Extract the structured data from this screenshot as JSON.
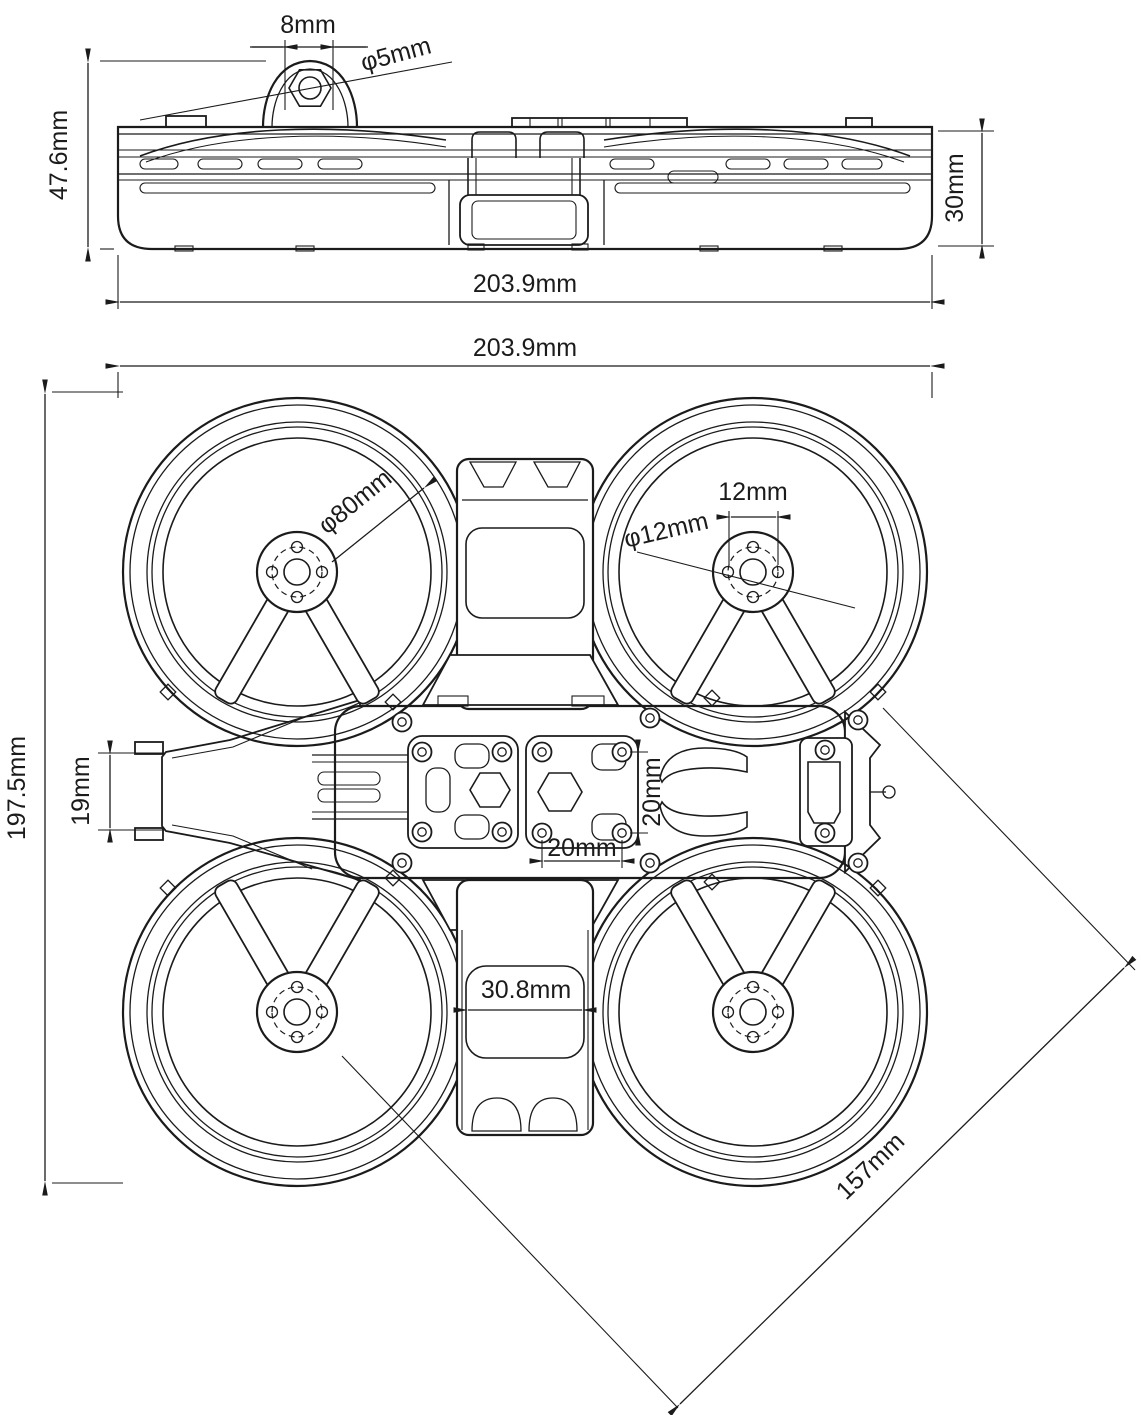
{
  "drawing_title": "cinewhoop-frame-dimension-drawing",
  "colors": {
    "line": "#1b1b1b",
    "background": "#ffffff"
  },
  "side_view": {
    "dims": {
      "mount_hole_spacing": "8mm",
      "mount_hole_diameter": "φ5mm",
      "overall_height": "47.6mm",
      "duct_height": "30mm",
      "overall_width": "203.9mm"
    }
  },
  "top_view": {
    "dims": {
      "overall_width": "203.9mm",
      "overall_length": "197.5mm",
      "camera_mount_height": "19mm",
      "duct_inner_diameter": "φ80mm",
      "motor_mount_hole_spacing": "12mm",
      "motor_mount_diameter": "φ12mm",
      "stack_hole_spacing_vertical": "20mm",
      "stack_hole_spacing_horizontal": "20mm",
      "center_plate_width": "30.8mm",
      "motor_to_motor_diagonal": "157mm"
    }
  }
}
